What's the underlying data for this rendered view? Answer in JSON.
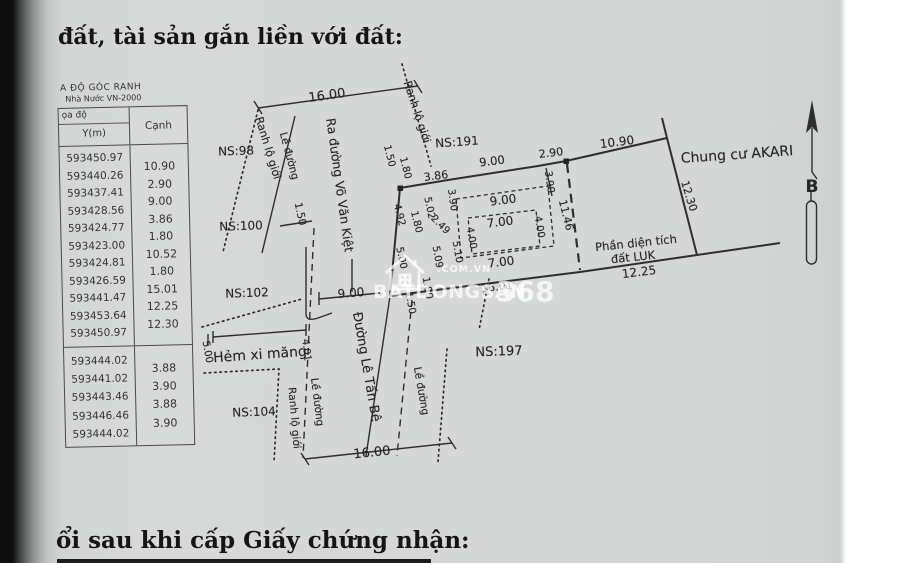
{
  "page": {
    "title_top": "đất, tài sản gắn liền với đất:",
    "title_bottom": "ổi sau khi cấp Giấy chứng nhận:"
  },
  "table": {
    "caption_line1": "A ĐỘ GÓC RANH",
    "caption_line2": "Nhà Nước VN-2000",
    "col_group_header": "ọa độ",
    "col1_header": "Y(m)",
    "col2_header": "Cạnh",
    "group1": {
      "y_values": [
        "593450.97",
        "593440.26",
        "593437.41",
        "593428.56",
        "593424.77",
        "593423.00",
        "593424.81",
        "593426.59",
        "593441.47",
        "593453.64",
        "593450.97"
      ],
      "edge_values": [
        "10.90",
        "2.90",
        "9.00",
        "3.86",
        "1.80",
        "10.52",
        "1.80",
        "15.01",
        "12.25",
        "12.30"
      ]
    },
    "group2": {
      "y_values": [
        "593444.02",
        "593441.02",
        "593443.46",
        "593446.46",
        "593444.02"
      ],
      "edge_values": [
        "3.88",
        "3.90",
        "3.88",
        "3.90"
      ]
    }
  },
  "drawing": {
    "north_label": "B",
    "watermark": {
      "brand": "BATDONGSAN",
      "number": "368",
      "domain": ".COM.VN"
    },
    "labels": [
      {
        "t": "16.00",
        "x": 327,
        "y": 96,
        "r": -8,
        "s": 13
      },
      {
        "t": "Ranh lộ giới",
        "x": 268,
        "y": 148,
        "r": 73,
        "s": 11
      },
      {
        "t": "Lề đường",
        "x": 289,
        "y": 156,
        "r": 75,
        "s": 10.5
      },
      {
        "t": "1.50",
        "x": 300,
        "y": 214,
        "r": 78,
        "s": 10.5
      },
      {
        "t": "Ra đường Võ Văn Kiệt",
        "x": 340,
        "y": 185,
        "r": 82,
        "s": 12.5
      },
      {
        "t": "Ranh lộ giới",
        "x": 417,
        "y": 112,
        "r": 72,
        "s": 11
      },
      {
        "t": "NS:98",
        "x": 236,
        "y": 151,
        "r": -2,
        "s": 12
      },
      {
        "t": "NS:100",
        "x": 241,
        "y": 226,
        "r": -2,
        "s": 12
      },
      {
        "t": "NS:102",
        "x": 247,
        "y": 293,
        "r": -2,
        "s": 12
      },
      {
        "t": "NS:104",
        "x": 254,
        "y": 412,
        "r": -2,
        "s": 12
      },
      {
        "t": "NS:191",
        "x": 457,
        "y": 142,
        "r": -4,
        "s": 12
      },
      {
        "t": "NS:197",
        "x": 499,
        "y": 352,
        "r": -2,
        "s": 13
      },
      {
        "t": "1.50",
        "x": 389,
        "y": 156,
        "r": 76,
        "s": 10
      },
      {
        "t": "1.80",
        "x": 405,
        "y": 168,
        "r": 76,
        "s": 10
      },
      {
        "t": "3.86",
        "x": 436,
        "y": 176,
        "r": -7,
        "s": 11
      },
      {
        "t": "9.00",
        "x": 492,
        "y": 161,
        "r": -7,
        "s": 11.5
      },
      {
        "t": "2.90",
        "x": 551,
        "y": 153,
        "r": -7,
        "s": 11
      },
      {
        "t": "10.90",
        "x": 617,
        "y": 142,
        "r": -7,
        "s": 12
      },
      {
        "t": "Chung cư AKARI",
        "x": 737,
        "y": 155,
        "r": -4,
        "s": 14
      },
      {
        "t": "12.30",
        "x": 689,
        "y": 196,
        "r": 73,
        "s": 11
      },
      {
        "t": "3.90",
        "x": 549,
        "y": 182,
        "r": 82,
        "s": 10
      },
      {
        "t": "11.46",
        "x": 566,
        "y": 215,
        "r": 76,
        "s": 11
      },
      {
        "t": "3.90",
        "x": 452,
        "y": 200,
        "r": 82,
        "s": 10
      },
      {
        "t": "5.02",
        "x": 429,
        "y": 208,
        "r": 78,
        "s": 10
      },
      {
        "t": "2.49",
        "x": 440,
        "y": 225,
        "r": 45,
        "s": 10
      },
      {
        "t": "4.92",
        "x": 399,
        "y": 215,
        "r": 76,
        "s": 10
      },
      {
        "t": "1.80",
        "x": 416,
        "y": 222,
        "r": 76,
        "s": 10
      },
      {
        "t": "9.00",
        "x": 503,
        "y": 200,
        "r": -7,
        "s": 12
      },
      {
        "t": "7.00",
        "x": 500,
        "y": 222,
        "r": -7,
        "s": 12
      },
      {
        "t": "4.00",
        "x": 471,
        "y": 238,
        "r": 80,
        "s": 10
      },
      {
        "t": "4.00",
        "x": 539,
        "y": 227,
        "r": 80,
        "s": 10
      },
      {
        "t": "7.00",
        "x": 501,
        "y": 262,
        "r": -7,
        "s": 12
      },
      {
        "t": "5.09",
        "x": 437,
        "y": 257,
        "r": 80,
        "s": 10
      },
      {
        "t": "5.10",
        "x": 457,
        "y": 252,
        "r": 80,
        "s": 10
      },
      {
        "t": "5.00",
        "x": 401,
        "y": 258,
        "r": 78,
        "s": 10
      },
      {
        "t": "1.80",
        "x": 427,
        "y": 288,
        "r": 80,
        "s": 10
      },
      {
        "t": "1.50",
        "x": 410,
        "y": 303,
        "r": 80,
        "s": 10
      },
      {
        "t": "Phần diện tích",
        "x": 636,
        "y": 243,
        "r": -6,
        "s": 11.5
      },
      {
        "t": "đất LUK",
        "x": 633,
        "y": 257,
        "r": -6,
        "s": 11.5
      },
      {
        "t": "12.25",
        "x": 639,
        "y": 272,
        "r": -7,
        "s": 12
      },
      {
        "t": "15.01",
        "x": 497,
        "y": 287,
        "r": -7,
        "s": 11
      },
      {
        "t": "Hẻm xi măng",
        "x": 260,
        "y": 355,
        "r": -4,
        "s": 14
      },
      {
        "t": "5.00",
        "x": 207,
        "y": 352,
        "r": 80,
        "s": 10
      },
      {
        "t": "4.01",
        "x": 306,
        "y": 350,
        "r": 84,
        "s": 10
      },
      {
        "t": "9.00",
        "x": 351,
        "y": 293,
        "r": -5,
        "s": 12
      },
      {
        "t": "Đường Lê Tấn Bê",
        "x": 366,
        "y": 367,
        "r": 80,
        "s": 13
      },
      {
        "t": "Lề đường",
        "x": 317,
        "y": 402,
        "r": 83,
        "s": 10.5
      },
      {
        "t": "Ranh lộ giới",
        "x": 294,
        "y": 418,
        "r": 85,
        "s": 10.5
      },
      {
        "t": "Lề đường",
        "x": 421,
        "y": 391,
        "r": 80,
        "s": 10.5
      },
      {
        "t": "16.00",
        "x": 372,
        "y": 453,
        "r": -6,
        "s": 13
      },
      {
        "t": "B",
        "x": 812,
        "y": 187,
        "r": 0,
        "s": 17,
        "b": 1
      }
    ]
  }
}
